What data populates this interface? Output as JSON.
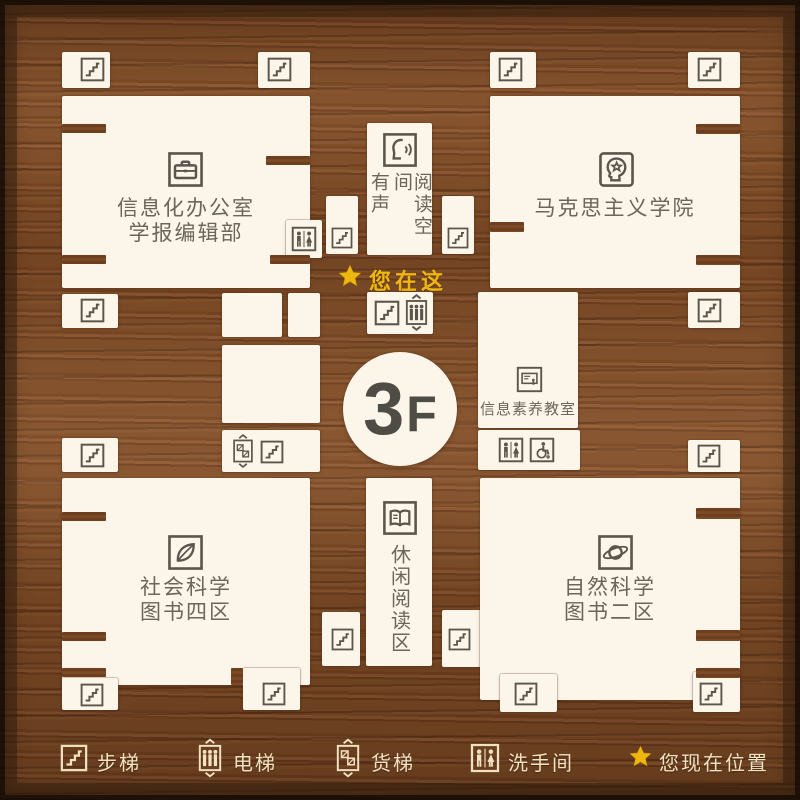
{
  "floor": {
    "number": "3",
    "suffix": "F"
  },
  "you_are_here": {
    "label": "您在这",
    "icon": "star-icon"
  },
  "rooms": {
    "info_office": {
      "line1": "信息化办公室",
      "line2": "学报编辑部",
      "icon": "briefcase-icon"
    },
    "marxism_school": {
      "name": "马克思主义学院",
      "icon": "head-star-icon"
    },
    "audio_reading": {
      "col_left": "有声",
      "col_right": "阅读空间",
      "icon": "speaking-face-icon"
    },
    "info_literacy": {
      "name": "信息素养教室",
      "icon": "screen-icon"
    },
    "social_science": {
      "line1": "社会科学",
      "line2": "图书四区",
      "icon": "leaf-icon"
    },
    "leisure_reading": {
      "name": "休闲阅读区",
      "icon": "open-book-icon"
    },
    "natural_science": {
      "line1": "自然科学",
      "line2": "图书二区",
      "icon": "saturn-icon"
    }
  },
  "legend": {
    "items": [
      {
        "icon": "stairs-icon",
        "label": "步梯"
      },
      {
        "icon": "elevator-icon",
        "label": "电梯"
      },
      {
        "icon": "freight-elevator-icon",
        "label": "货梯"
      },
      {
        "icon": "restroom-icon",
        "label": "洗手间"
      },
      {
        "icon": "star-icon",
        "label": "您现在位置"
      }
    ]
  },
  "colors": {
    "wood": "#7e4b26",
    "room": "#fbf5ea",
    "icon": "#5b554b",
    "label": "#6b655a",
    "gold": "#eeb70e",
    "legend_text": "#f2e2c0",
    "floor_text": "#4f4b45"
  }
}
